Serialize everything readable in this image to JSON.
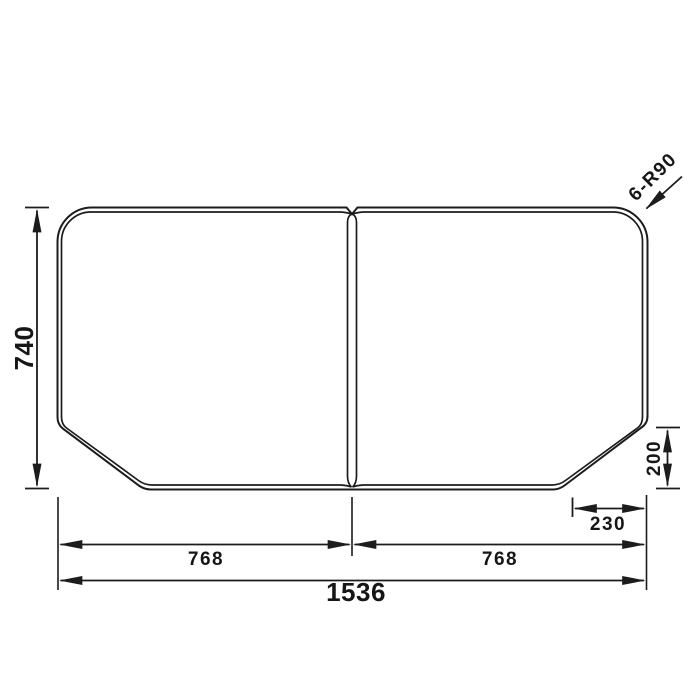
{
  "labels": {
    "height": "740",
    "left_panel_width": "768",
    "right_panel_width": "768",
    "total_width": "1536",
    "corner_cut_height": "200",
    "corner_cut_width": "230",
    "corner_radius_note": "6-R90"
  },
  "colors": {
    "line": "#1c1c1c",
    "text": "#161616",
    "background": "#ffffff"
  }
}
